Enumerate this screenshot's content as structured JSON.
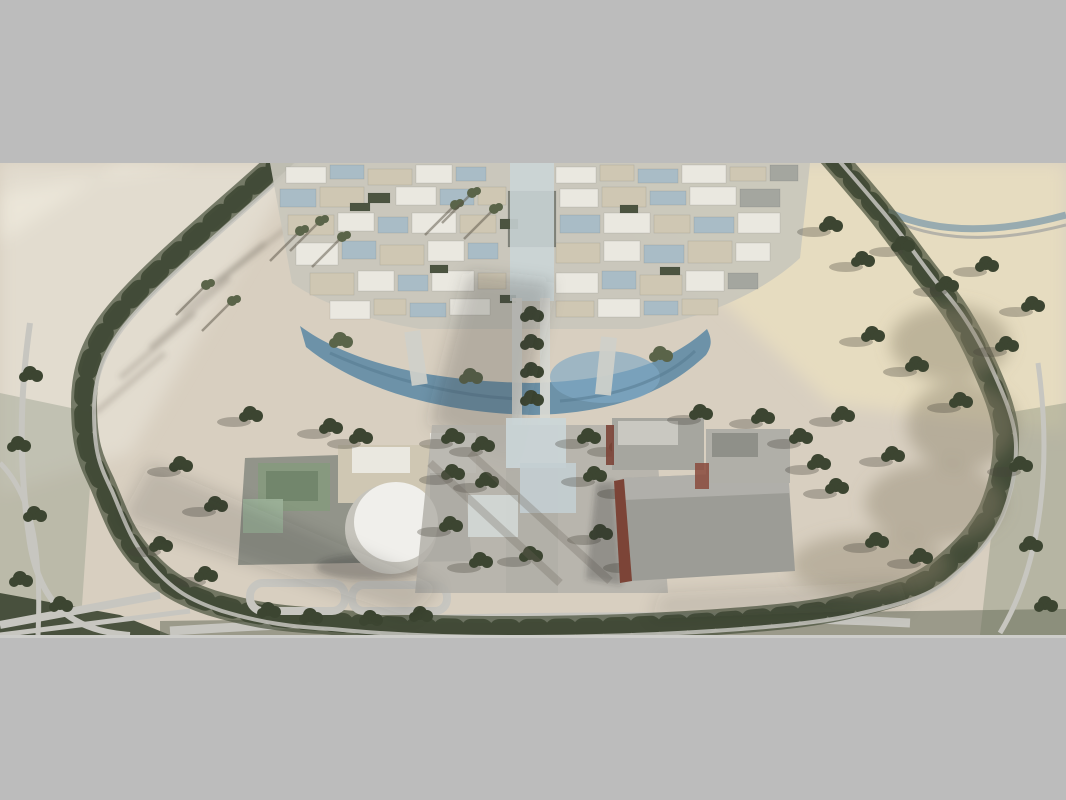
{
  "scene": {
    "type": "architectural-aerial-render",
    "description": "Letterboxed aerial 3D rendering of a desert campus masterplan: a tree-lined ring road encloses a dense cluster of low beige, white and glass buildings around a central boulevard spine, a crescent lake below the cluster, a southern group with a white cylindrical auditorium, a tree-dotted plaza, gray halls with red-brown walls, and scattered trees with long shadows on the sand."
  },
  "palette": {
    "letterbox": "#bcbcbc",
    "letterbox_edge": "#cdcdca",
    "sand_base": "#d8cfc0",
    "sand_warm": "#e6dcc0",
    "sand_pale": "#e2dccf",
    "sand_shadowed": "#c7c0b2",
    "greenbelt": "#47503a",
    "tree_dark": "#3c4531",
    "tree_mid": "#5a6449",
    "road_light": "#c7c6c0",
    "road_gray": "#a7a8a2",
    "water": "#6d92a8",
    "water_bright": "#7fa9c4",
    "water_dark": "#54788d",
    "campus_base": "#c9c7bc",
    "bldg_white": "#eae8e0",
    "bldg_beige": "#cfc7b3",
    "bldg_gray": "#a4a69f",
    "bldg_dark": "#82857b",
    "glass_blue": "#a9bcc6",
    "glass_teal": "#7e99a7",
    "glass_green": "#87997f",
    "red_brown": "#7c4437",
    "drum_white": "#f0efeb",
    "drum_shade": "#c6c4bc",
    "plaza": "#b3b0a9",
    "shadow": "rgba(55,55,48,0.30)",
    "sun": "rgba(255,252,240,0.30)"
  }
}
